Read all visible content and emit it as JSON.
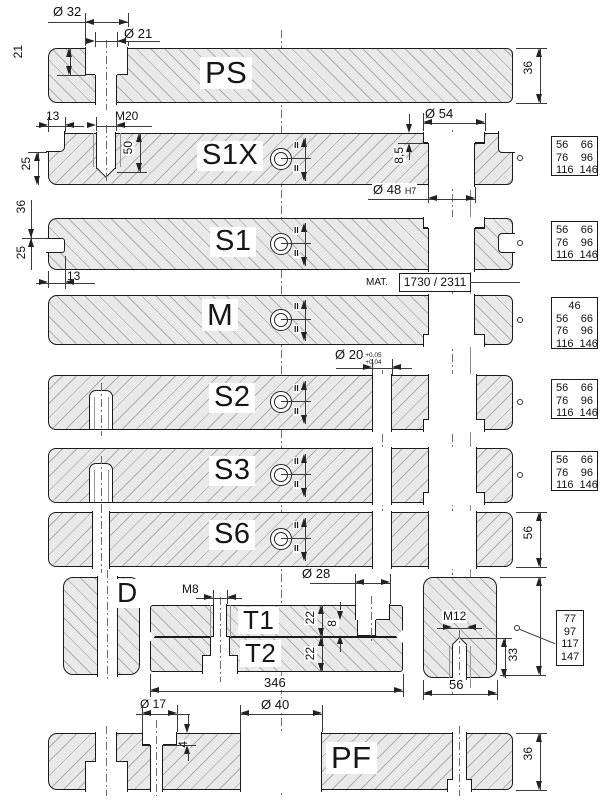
{
  "drawing": {
    "kind": "mold-base plate cross-sections"
  },
  "plates": {
    "ps": {
      "label": "PS"
    },
    "s1x": {
      "label": "S1X"
    },
    "s1": {
      "label": "S1"
    },
    "m": {
      "label": "M"
    },
    "s2": {
      "label": "S2"
    },
    "s3": {
      "label": "S3"
    },
    "s6": {
      "label": "S6"
    },
    "d": {
      "label": "D"
    },
    "t1": {
      "label": "T1"
    },
    "t2": {
      "label": "T2"
    },
    "pf": {
      "label": "PF"
    }
  },
  "dims": {
    "ps": {
      "counterbore_dia": "Ø 32",
      "hole_dia": "Ø 21",
      "counterbore_depth": "21",
      "thickness": "36"
    },
    "s1x": {
      "offset": "13",
      "thread": "M20",
      "thread_depth": "50",
      "ledge_height": "25",
      "counterbore_dia": "Ø 54",
      "counterbore_depth": "8,5",
      "hole_dia": "Ø 48",
      "hole_fit": "H7"
    },
    "s1": {
      "upper": "36",
      "lower": "25",
      "offset": "13"
    },
    "m": {
      "hole_dia": "Ø 20",
      "tol_upper": "+0,05",
      "tol_lower": "+0,04"
    },
    "s6": {
      "thickness": "56"
    },
    "t": {
      "thread": "M8",
      "counterbore_dia": "Ø 28",
      "t1_thickness": "22",
      "pocket_depth": "8",
      "t2_thickness": "22",
      "length": "346"
    },
    "block": {
      "thread": "M12",
      "depth": "33",
      "width": "56"
    },
    "pf": {
      "counterbore_dia": "Ø 17",
      "counterbore_depth": "4",
      "hole_dia": "Ø 40",
      "thickness": "36"
    }
  },
  "material_note": {
    "label": "MAT.",
    "value": "1730 / 2311"
  },
  "size_tables": {
    "s1x": [
      [
        "56",
        "66"
      ],
      [
        "76",
        "96"
      ],
      [
        "116",
        "146"
      ]
    ],
    "s1": [
      [
        "56",
        "66"
      ],
      [
        "76",
        "96"
      ],
      [
        "116",
        "146"
      ]
    ],
    "m": [
      [
        "46"
      ],
      [
        "56",
        "66"
      ],
      [
        "76",
        "96"
      ],
      [
        "116",
        "146"
      ]
    ],
    "s2": [
      [
        "56",
        "66"
      ],
      [
        "76",
        "96"
      ],
      [
        "116",
        "146"
      ]
    ],
    "s3": [
      [
        "56",
        "66"
      ],
      [
        "76",
        "96"
      ],
      [
        "116",
        "146"
      ]
    ],
    "stack": [
      [
        "77"
      ],
      [
        "97"
      ],
      [
        "117"
      ],
      [
        "147"
      ]
    ]
  },
  "symbols": {
    "parallel_mark": "II"
  }
}
